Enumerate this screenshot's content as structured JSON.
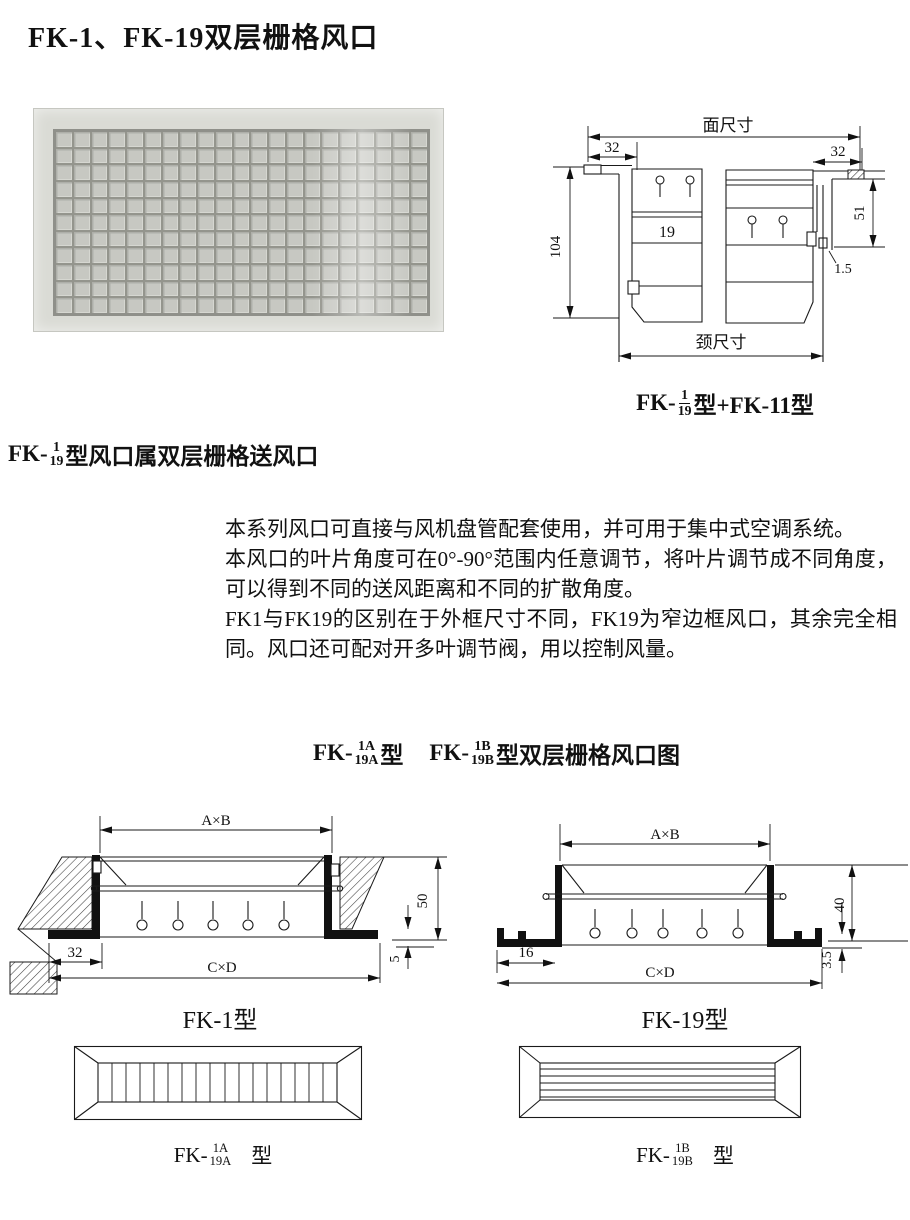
{
  "title": "FK-1、FK-19双层栅格风口",
  "photo": {
    "cols": 21,
    "rows": 11
  },
  "drawing1": {
    "labels": {
      "face_dim": "面尺寸",
      "neck_dim": "颈尺寸",
      "left_32": "32",
      "right_32": "32",
      "height_104": "104",
      "height_51": "51",
      "gap_1_5": "1.5",
      "inner_19": "19"
    },
    "caption": {
      "prefix": "FK-",
      "num": "1",
      "den": "19",
      "suffix": "型+FK-11型"
    }
  },
  "intro": {
    "heading": {
      "prefix": "FK-",
      "num": "1",
      "den": "19",
      "suffix": "型风口属双层栅格送风口"
    },
    "paragraphs": [
      "本系列风口可直接与风机盘管配套使用，并可用于集中式空调系统。",
      "本风口的叶片角度可在0°-90°范围内任意调节，将叶片调节成不同角度，可以得到不同的送风距离和不同的扩散角度。",
      "FK1与FK19的区别在于外框尺寸不同，FK19为窄边框风口，其余完全相同。风口还可配对开多叶调节阀，用以控制风量。"
    ]
  },
  "section_heading": {
    "a": {
      "prefix": "FK-",
      "num": "1A",
      "den": "19A",
      "suffix": "型"
    },
    "b": {
      "prefix": "FK-",
      "num": "1B",
      "den": "19B",
      "suffix": "型双层栅格风口图"
    }
  },
  "fk1": {
    "labels": {
      "ab": "A×B",
      "cd": "C×D",
      "w32": "32",
      "h50": "50",
      "t5": "5"
    },
    "caption": "FK-1型"
  },
  "fk19": {
    "labels": {
      "ab": "A×B",
      "cd": "C×D",
      "w16": "16",
      "h40": "40",
      "t35": "3.5"
    },
    "caption": "FK-19型"
  },
  "face_a": {
    "caption": {
      "prefix": "FK-",
      "num": "1A",
      "den": "19A",
      "suffix": "型"
    }
  },
  "face_b": {
    "caption": {
      "prefix": "FK-",
      "num": "1B",
      "den": "19B",
      "suffix": "型"
    }
  }
}
